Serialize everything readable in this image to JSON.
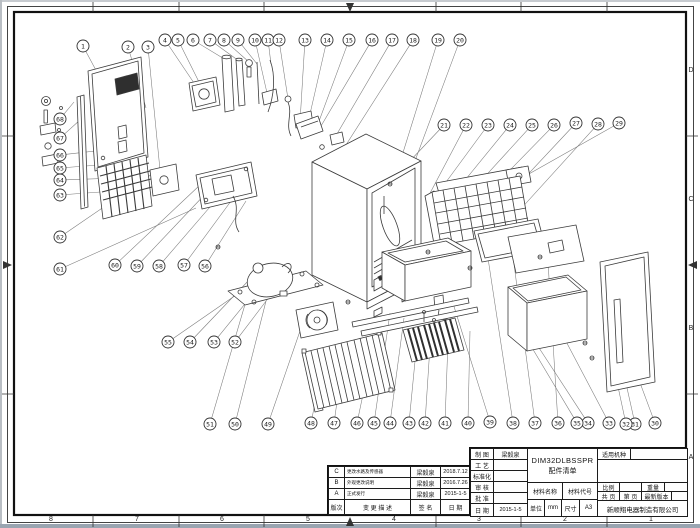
{
  "sheet": {
    "zones": {
      "columns": [
        "8",
        "7",
        "6",
        "5",
        "4",
        "3",
        "2",
        "1"
      ],
      "rows": [
        "D",
        "C",
        "B",
        "A"
      ]
    }
  },
  "title_block": {
    "info_rows": [
      {
        "label": "制 图",
        "value": "梁毅泉"
      },
      {
        "label": "工 艺",
        "value": ""
      },
      {
        "label": "标准化",
        "value": ""
      },
      {
        "label": "审 核",
        "value": ""
      },
      {
        "label": "批 准",
        "value": ""
      },
      {
        "label": "日 期",
        "value": "2015-1-5"
      }
    ],
    "title_line1": "DIM32DLBSSPR",
    "title_line2": "配件清单",
    "material_name_label": "材料名称",
    "material_code_label": "材料代号",
    "unit_label": "单位",
    "unit_value": "mm",
    "size_label": "尺寸",
    "size_value": "A3",
    "applicable_label": "适用机种",
    "scale_label": "比例",
    "weight_label": "重量",
    "total_pages_label": "共  页",
    "page_label": "第  页",
    "latest_version_label": "最新版本",
    "company": "新顺翔电器制造有限公司"
  },
  "revision_table": {
    "headers": {
      "rev": "版次",
      "desc": "变 更 描 述",
      "sign": "签 名",
      "date": "日 期"
    },
    "rows": [
      {
        "rev": "C",
        "desc": "更改水路及传感器",
        "sign": "梁毅泉",
        "date": "2018.7.12"
      },
      {
        "rev": "B",
        "desc": "外观更改说明",
        "sign": "梁毅泉",
        "date": "2016.7.26"
      },
      {
        "rev": "A",
        "desc": "正式发行",
        "sign": "梁毅泉",
        "date": "2015-1-5"
      }
    ]
  },
  "balloons": [
    {
      "n": 1,
      "x": 83,
      "y": 46,
      "tx": 112,
      "ty": 100
    },
    {
      "n": 2,
      "x": 128,
      "y": 47,
      "tx": 146,
      "ty": 108
    },
    {
      "n": 3,
      "x": 148,
      "y": 47,
      "tx": 160,
      "ty": 170
    },
    {
      "n": 4,
      "x": 165,
      "y": 40,
      "tx": 196,
      "ty": 86
    },
    {
      "n": 5,
      "x": 178,
      "y": 40,
      "tx": 204,
      "ty": 92
    },
    {
      "n": 6,
      "x": 193,
      "y": 40,
      "tx": 226,
      "ty": 60
    },
    {
      "n": 7,
      "x": 210,
      "y": 40,
      "tx": 239,
      "ty": 61
    },
    {
      "n": 8,
      "x": 224,
      "y": 40,
      "tx": 249,
      "ty": 62
    },
    {
      "n": 9,
      "x": 238,
      "y": 40,
      "tx": 257,
      "ty": 64
    },
    {
      "n": 10,
      "x": 255,
      "y": 40,
      "tx": 267,
      "ty": 93
    },
    {
      "n": 11,
      "x": 268,
      "y": 40,
      "tx": 271,
      "ty": 64
    },
    {
      "n": 12,
      "x": 279,
      "y": 40,
      "tx": 288,
      "ty": 99
    },
    {
      "n": 13,
      "x": 305,
      "y": 40,
      "tx": 300,
      "ty": 122
    },
    {
      "n": 14,
      "x": 327,
      "y": 40,
      "tx": 307,
      "ty": 127
    },
    {
      "n": 15,
      "x": 349,
      "y": 40,
      "tx": 315,
      "ty": 132
    },
    {
      "n": 16,
      "x": 372,
      "y": 40,
      "tx": 321,
      "ty": 126
    },
    {
      "n": 17,
      "x": 392,
      "y": 40,
      "tx": 334,
      "ty": 139
    },
    {
      "n": 18,
      "x": 413,
      "y": 40,
      "tx": 344,
      "ty": 148
    },
    {
      "n": 19,
      "x": 438,
      "y": 40,
      "tx": 387,
      "ty": 204
    },
    {
      "n": 20,
      "x": 460,
      "y": 40,
      "tx": 393,
      "ty": 220
    },
    {
      "n": 21,
      "x": 444,
      "y": 125,
      "tx": 390,
      "ty": 182
    },
    {
      "n": 22,
      "x": 466,
      "y": 125,
      "tx": 428,
      "ty": 197
    },
    {
      "n": 23,
      "x": 488,
      "y": 125,
      "tx": 438,
      "ty": 193
    },
    {
      "n": 24,
      "x": 510,
      "y": 125,
      "tx": 448,
      "ty": 201
    },
    {
      "n": 25,
      "x": 532,
      "y": 125,
      "tx": 458,
      "ty": 206
    },
    {
      "n": 26,
      "x": 554,
      "y": 125,
      "tx": 470,
      "ty": 211
    },
    {
      "n": 27,
      "x": 576,
      "y": 123,
      "tx": 488,
      "ty": 217
    },
    {
      "n": 28,
      "x": 598,
      "y": 124,
      "tx": 508,
      "ty": 223
    },
    {
      "n": 29,
      "x": 619,
      "y": 123,
      "tx": 520,
      "ty": 179
    },
    {
      "n": 30,
      "x": 655,
      "y": 423,
      "tx": 636,
      "ty": 372
    },
    {
      "n": 31,
      "x": 635,
      "y": 424,
      "tx": 621,
      "ty": 361
    },
    {
      "n": 32,
      "x": 626,
      "y": 424,
      "tx": 611,
      "ty": 354
    },
    {
      "n": 33,
      "x": 609,
      "y": 423,
      "tx": 560,
      "ty": 330
    },
    {
      "n": 34,
      "x": 588,
      "y": 423,
      "tx": 528,
      "ty": 331
    },
    {
      "n": 35,
      "x": 577,
      "y": 423,
      "tx": 516,
      "ty": 321
    },
    {
      "n": 36,
      "x": 558,
      "y": 423,
      "tx": 548,
      "ty": 262
    },
    {
      "n": 37,
      "x": 535,
      "y": 423,
      "tx": 512,
      "ty": 249
    },
    {
      "n": 38,
      "x": 513,
      "y": 423,
      "tx": 486,
      "ty": 245
    },
    {
      "n": 39,
      "x": 490,
      "y": 422,
      "tx": 452,
      "ty": 300
    },
    {
      "n": 40,
      "x": 468,
      "y": 423,
      "tx": 470,
      "ty": 331
    },
    {
      "n": 41,
      "x": 445,
      "y": 423,
      "tx": 448,
      "ty": 341
    },
    {
      "n": 42,
      "x": 425,
      "y": 423,
      "tx": 430,
      "ty": 346
    },
    {
      "n": 43,
      "x": 409,
      "y": 423,
      "tx": 416,
      "ty": 351
    },
    {
      "n": 44,
      "x": 390,
      "y": 423,
      "tx": 404,
      "ty": 318
    },
    {
      "n": 45,
      "x": 374,
      "y": 423,
      "tx": 390,
      "ty": 313
    },
    {
      "n": 46,
      "x": 357,
      "y": 423,
      "tx": 370,
      "ty": 361
    },
    {
      "n": 47,
      "x": 334,
      "y": 423,
      "tx": 344,
      "ty": 351
    },
    {
      "n": 48,
      "x": 311,
      "y": 423,
      "tx": 322,
      "ty": 369
    },
    {
      "n": 49,
      "x": 268,
      "y": 424,
      "tx": 300,
      "ty": 331
    },
    {
      "n": 50,
      "x": 235,
      "y": 424,
      "tx": 266,
      "ty": 301
    },
    {
      "n": 51,
      "x": 210,
      "y": 424,
      "tx": 246,
      "ty": 301
    },
    {
      "n": 52,
      "x": 235,
      "y": 342,
      "tx": 276,
      "ty": 288
    },
    {
      "n": 53,
      "x": 214,
      "y": 342,
      "tx": 262,
      "ty": 283
    },
    {
      "n": 54,
      "x": 190,
      "y": 342,
      "tx": 250,
      "ty": 279
    },
    {
      "n": 55,
      "x": 168,
      "y": 342,
      "tx": 236,
      "ty": 295
    },
    {
      "n": 56,
      "x": 205,
      "y": 266,
      "tx": 246,
      "ty": 201
    },
    {
      "n": 57,
      "x": 184,
      "y": 265,
      "tx": 234,
      "ty": 197
    },
    {
      "n": 58,
      "x": 159,
      "y": 266,
      "tx": 222,
      "ty": 193
    },
    {
      "n": 59,
      "x": 137,
      "y": 266,
      "tx": 210,
      "ty": 189
    },
    {
      "n": 60,
      "x": 115,
      "y": 265,
      "tx": 200,
      "ty": 185
    },
    {
      "n": 61,
      "x": 60,
      "y": 269,
      "tx": 196,
      "ty": 208
    },
    {
      "n": 62,
      "x": 60,
      "y": 237,
      "tx": 152,
      "ty": 174
    },
    {
      "n": 63,
      "x": 60,
      "y": 195,
      "tx": 128,
      "ty": 190
    },
    {
      "n": 64,
      "x": 60,
      "y": 180,
      "tx": 118,
      "ty": 178
    },
    {
      "n": 65,
      "x": 60,
      "y": 168,
      "tx": 112,
      "ty": 164
    },
    {
      "n": 66,
      "x": 60,
      "y": 155,
      "tx": 104,
      "ty": 150
    },
    {
      "n": 67,
      "x": 60,
      "y": 138,
      "tx": 80,
      "ty": 120
    },
    {
      "n": 68,
      "x": 60,
      "y": 119,
      "tx": 74,
      "ty": 102
    }
  ]
}
